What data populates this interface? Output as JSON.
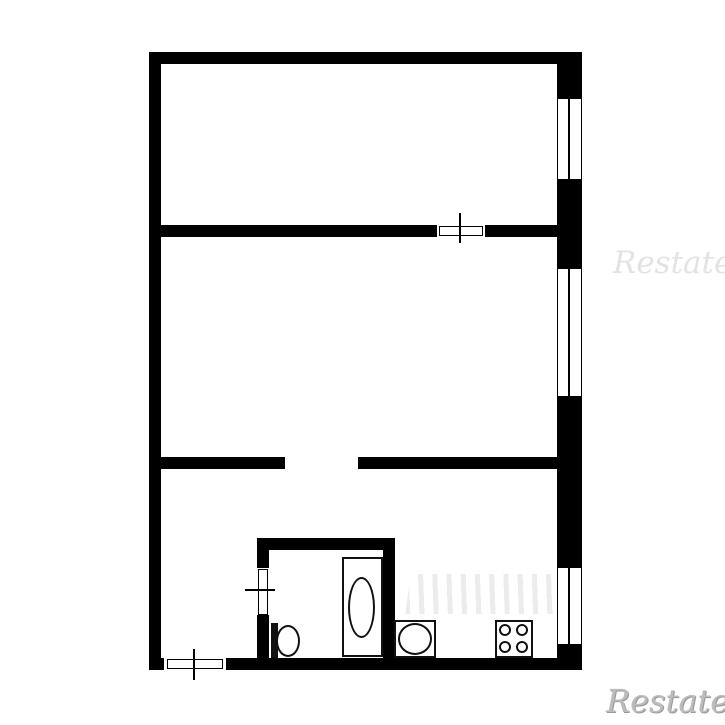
{
  "document": {
    "type": "apartment-floor-plan"
  },
  "colors": {
    "wall": "#000000",
    "background": "#ffffff",
    "fixture_line": "#111111",
    "watermark_light": "#e3e3e3",
    "watermark_dark": "#bcbcbc",
    "watermark_faint": "#ececec"
  },
  "watermarks": {
    "right_text": "Restate",
    "bottom_right_text": "Restate"
  },
  "plan": {
    "walls": [
      {
        "name": "wall-top",
        "x": 149,
        "y": 52,
        "w": 433,
        "h": 12
      },
      {
        "name": "wall-left",
        "x": 149,
        "y": 52,
        "w": 12,
        "h": 618
      },
      {
        "name": "wall-right",
        "x": 557,
        "y": 52,
        "w": 25,
        "h": 618
      },
      {
        "name": "wall-bottom",
        "x": 149,
        "y": 658,
        "w": 433,
        "h": 12
      },
      {
        "name": "wall-divider-upper",
        "x": 161,
        "y": 225,
        "w": 396,
        "h": 12
      },
      {
        "name": "wall-divider-lower-left",
        "x": 161,
        "y": 457,
        "w": 124,
        "h": 12
      },
      {
        "name": "wall-divider-lower-right",
        "x": 358,
        "y": 457,
        "w": 199,
        "h": 12
      },
      {
        "name": "wall-bathroom-top",
        "x": 257,
        "y": 538,
        "w": 138,
        "h": 12
      },
      {
        "name": "wall-bathroom-left",
        "x": 257,
        "y": 550,
        "w": 12,
        "h": 108
      },
      {
        "name": "wall-bathroom-right",
        "x": 383,
        "y": 550,
        "w": 12,
        "h": 108
      }
    ],
    "openings": [
      {
        "name": "opening-upper-door",
        "x": 437,
        "y": 225,
        "w": 48,
        "h": 12
      },
      {
        "name": "opening-entrance-door",
        "x": 164,
        "y": 658,
        "w": 62,
        "h": 12
      },
      {
        "name": "opening-bathroom-door",
        "x": 257,
        "y": 568,
        "w": 12,
        "h": 47
      }
    ],
    "windows": [
      {
        "name": "window-top-room",
        "x": 557,
        "y": 98,
        "w": 25,
        "h": 82
      },
      {
        "name": "window-middle-room",
        "x": 557,
        "y": 268,
        "w": 25,
        "h": 129
      },
      {
        "name": "window-kitchen",
        "x": 557,
        "y": 567,
        "w": 25,
        "h": 78
      }
    ],
    "doors": [
      {
        "name": "door-upper-room",
        "leaf": {
          "x": 439,
          "y": 226,
          "w": 44,
          "h": 10
        },
        "tick": {
          "x": 459,
          "y": 213,
          "w": 2,
          "h": 30
        }
      },
      {
        "name": "door-entrance",
        "leaf": {
          "x": 167,
          "y": 659,
          "w": 56,
          "h": 10
        },
        "tick": {
          "x": 193,
          "y": 649,
          "w": 2,
          "h": 31
        }
      },
      {
        "name": "door-bathroom",
        "leaf": {
          "x": 258,
          "y": 569,
          "w": 10,
          "h": 46
        },
        "tick": {
          "x": 245,
          "y": 589,
          "w": 30,
          "h": 2
        }
      }
    ],
    "fixtures": {
      "bathtub": {
        "outer": {
          "x": 342,
          "y": 557,
          "w": 41,
          "h": 100
        },
        "basin": {
          "x": 348,
          "y": 577,
          "w": 27,
          "h": 61
        }
      },
      "toilet": {
        "tank": {
          "x": 271,
          "y": 623,
          "w": 7,
          "h": 35
        },
        "bowl": {
          "x": 276,
          "y": 625,
          "w": 24,
          "h": 32
        }
      },
      "kitchen_sink": {
        "box": {
          "x": 394,
          "y": 620,
          "w": 42,
          "h": 38
        },
        "basin": {
          "x": 398,
          "y": 623,
          "w": 34,
          "h": 32
        }
      },
      "stove": {
        "box": {
          "x": 495,
          "y": 620,
          "w": 38,
          "h": 38
        },
        "burners": [
          {
            "x": 499,
            "y": 624,
            "w": 12,
            "h": 12
          },
          {
            "x": 516,
            "y": 624,
            "w": 12,
            "h": 12
          },
          {
            "x": 499,
            "y": 641,
            "w": 12,
            "h": 12
          },
          {
            "x": 516,
            "y": 641,
            "w": 12,
            "h": 12
          }
        ]
      }
    },
    "watermark_bars": {
      "x": 408,
      "y": 574,
      "w": 152,
      "h": 40
    }
  }
}
